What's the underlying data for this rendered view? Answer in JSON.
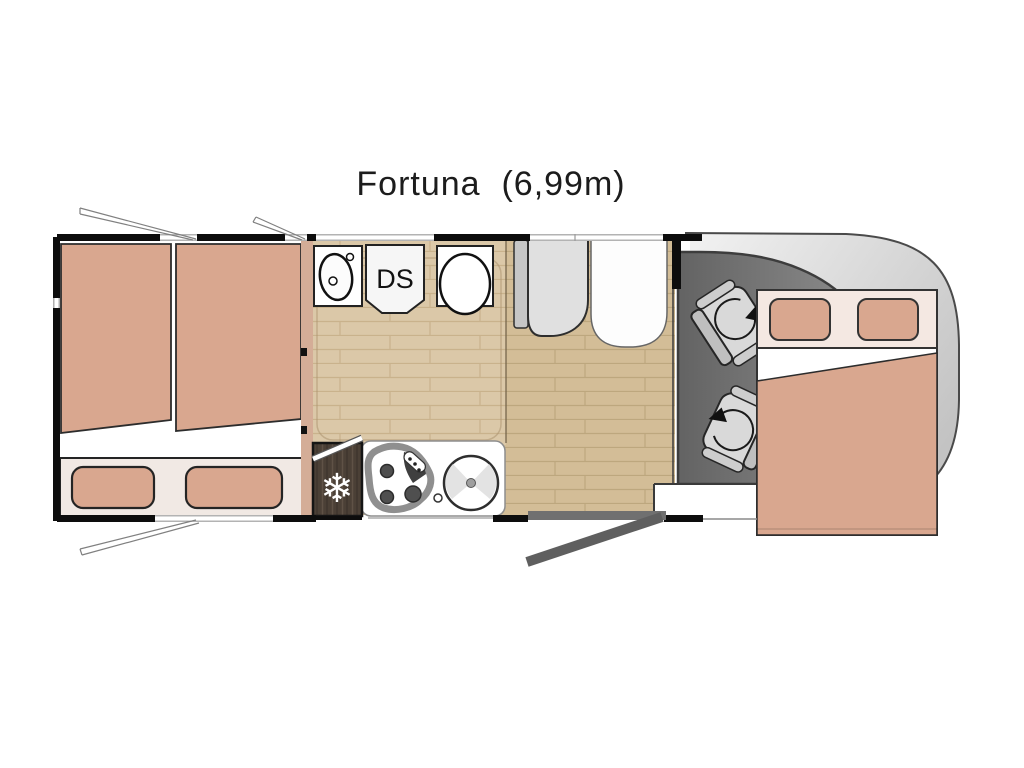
{
  "title": "Fortuna  (6,99m)",
  "rooms": {
    "rear_bedroom": {
      "name": "twin-single-beds"
    },
    "bathroom": {
      "shower_label": "DS",
      "fixtures": [
        "washbasin",
        "shower",
        "toilet"
      ]
    },
    "kitchen": {
      "fridge_icon": "❄",
      "fixtures": [
        "fridge-freezer",
        "three-burner-hob",
        "round-sink"
      ]
    },
    "dinette": {
      "fixtures": [
        "bench-seat",
        "table"
      ]
    },
    "cab": {
      "fixtures": [
        "driver-swivel-seat",
        "passenger-swivel-seat"
      ]
    },
    "front_bed": {
      "name": "drop-down-double-bed"
    }
  },
  "colors": {
    "upholstery_salmon": "#d9a78f",
    "upholstery_light": "#f4e8e2",
    "wood_floor_light": "#dbc8a8",
    "wood_floor_dark": "#d3bd97",
    "fridge_wood_dark": "#4b4036",
    "cab_floor_gray": "#7a7a7a",
    "body_gray": "#d9d9d9",
    "wall_black": "#0d0d0d"
  }
}
